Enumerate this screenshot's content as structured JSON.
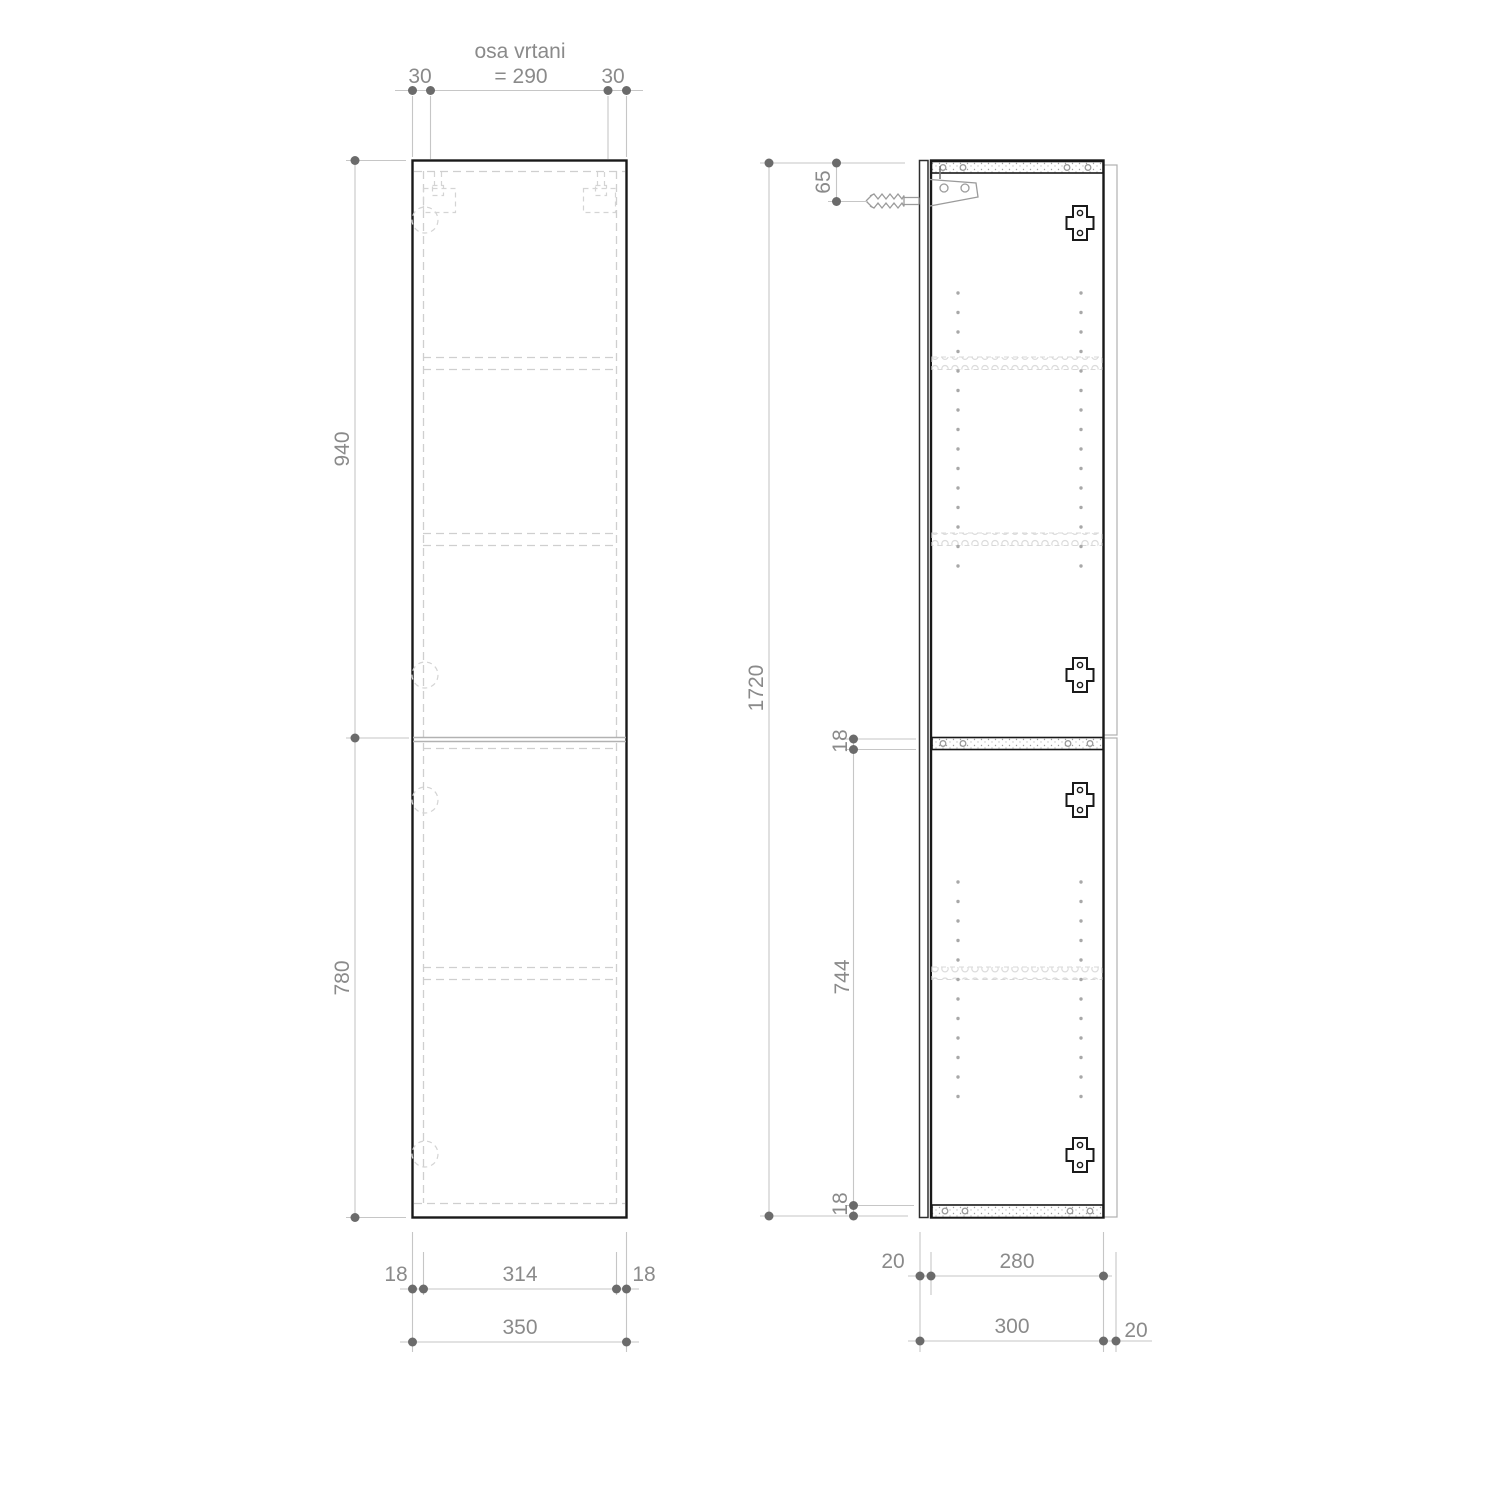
{
  "front_view": {
    "drill_note_line1": "osa vrtani",
    "drill_note_line2": "= 290",
    "drill_offset_left": "30",
    "drill_offset_right": "30",
    "upper_door_height": "940",
    "lower_door_height": "780",
    "bottom_left_inset": "18",
    "bottom_inner_width": "314",
    "bottom_right_inset": "18",
    "bottom_total_width": "350"
  },
  "side_view": {
    "total_height": "1720",
    "hanger_axis_offset": "65",
    "mid_panel_thickness": "18",
    "lower_inner_height": "744",
    "bottom_panel_thickness": "18",
    "door_thickness": "20",
    "inner_depth": "280",
    "overall_depth": "300",
    "wall_rail_depth": "20"
  }
}
